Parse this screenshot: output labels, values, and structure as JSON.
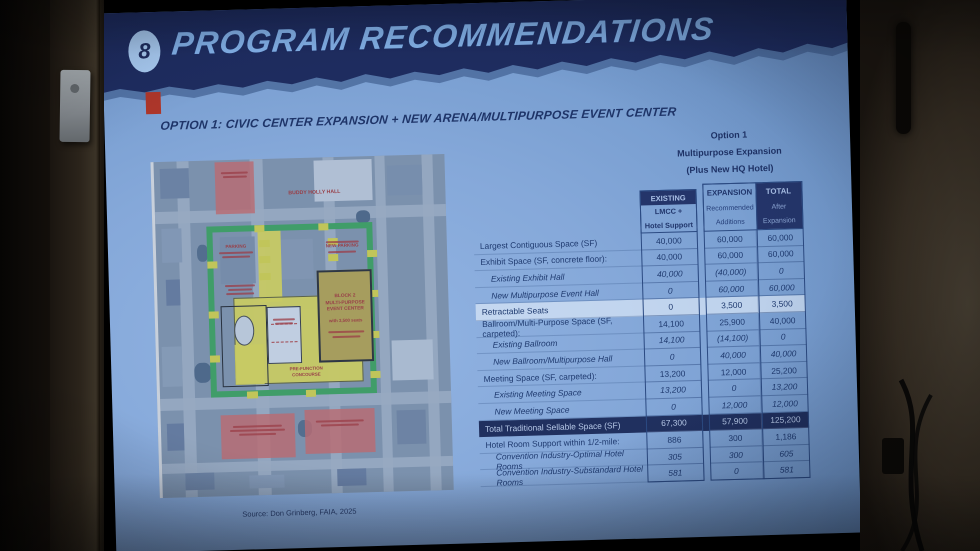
{
  "slide": {
    "badge_number": "8",
    "title": "PROGRAM RECOMMENDATIONS",
    "subtitle": "OPTION 1: CIVIC CENTER EXPANSION + NEW ARENA/MULTIPURPOSE EVENT CENTER",
    "source": "Source: Don Grinberg, FAIA, 2025"
  },
  "option_note": {
    "line1": "Option 1",
    "line2": "Multipurpose Expansion",
    "line3": "(Plus New HQ Hotel)"
  },
  "table": {
    "col_headers": {
      "existing": {
        "line1": "EXISTING",
        "line2": "LMCC +",
        "line3": "Hotel Support"
      },
      "expansion": {
        "line1": "EXPANSION",
        "line2": "Recommended",
        "line3": "Additions"
      },
      "total": {
        "line1": "TOTAL",
        "line2": "After",
        "line3": "Expansion"
      }
    },
    "rows": [
      {
        "label": "Largest Contiguous Space (SF)",
        "existing": "40,000",
        "expansion": "60,000",
        "total": "60,000"
      },
      {
        "label": "Exhibit Space (SF, concrete floor):",
        "existing": "40,000",
        "expansion": "60,000",
        "total": "60,000"
      },
      {
        "label": "Existing Exhibit Hall",
        "existing": "40,000",
        "expansion": "(40,000)",
        "total": "0"
      },
      {
        "label": "New Multipurpose Event Hall",
        "existing": "0",
        "expansion": "60,000",
        "total": "60,000"
      },
      {
        "label": "Retractable Seats",
        "existing": "0",
        "expansion": "3,500",
        "total": "3,500"
      },
      {
        "label": "Ballroom/Multi-Purpose Space (SF, carpeted):",
        "existing": "14,100",
        "expansion": "25,900",
        "total": "40,000"
      },
      {
        "label": "Existing Ballroom",
        "existing": "14,100",
        "expansion": "(14,100)",
        "total": "0"
      },
      {
        "label": "New Ballroom/Multipurpose Hall",
        "existing": "0",
        "expansion": "40,000",
        "total": "40,000"
      },
      {
        "label": "Meeting Space (SF, carpeted):",
        "existing": "13,200",
        "expansion": "12,000",
        "total": "25,200"
      },
      {
        "label": "Existing Meeting Space",
        "existing": "13,200",
        "expansion": "0",
        "total": "13,200"
      },
      {
        "label": "New Meeting Space",
        "existing": "0",
        "expansion": "12,000",
        "total": "12,000"
      },
      {
        "label": "Total Traditional Sellable Space (SF)",
        "existing": "67,300",
        "expansion": "57,900",
        "total": "125,200"
      },
      {
        "label": "Hotel Room Support within 1/2-mile:",
        "existing": "886",
        "expansion": "300",
        "total": "1,186"
      },
      {
        "label": "Convention Industry-Optimal Hotel Rooms",
        "existing": "305",
        "expansion": "300",
        "total": "605"
      },
      {
        "label": "Convention Industry-Substandard Hotel Rooms",
        "existing": "581",
        "expansion": "0",
        "total": "581"
      }
    ]
  },
  "map": {
    "labels": {
      "buddy_holly_hall": "BUDDY HOLLY HALL",
      "parking": "PARKING",
      "new_parking": "NEW PARKING",
      "block2_line1": "BLOCK 2",
      "block2_line2": "MULTI-PURPOSE",
      "block2_line3": "EVENT CENTER",
      "block2_seats": "with 3,500 seats",
      "prefunction_line1": "PRE-FUNCTION",
      "prefunction_line2": "CONCOURSE"
    }
  },
  "colors": {
    "header_navy": "#1e2c5f",
    "slide_blue": "#85a8d9",
    "accent_red": "#ae362a",
    "campus_green": "#2fa94a",
    "zone_yellow": "#ece43a",
    "event_olive": "#c2a636",
    "table_text_navy": "#1f3a6f"
  }
}
